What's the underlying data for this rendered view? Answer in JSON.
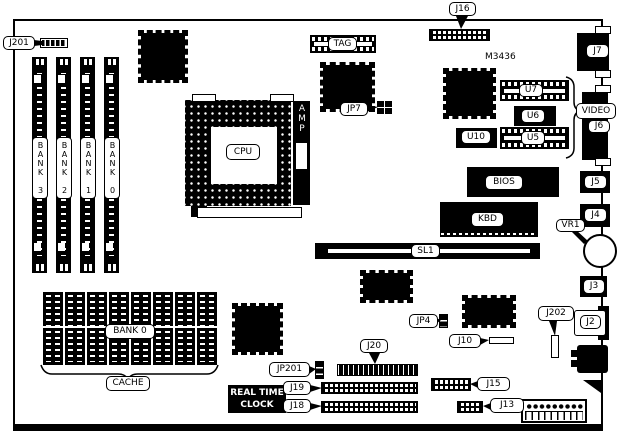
{
  "diagram": {
    "model": "M3436",
    "rtc": {
      "line1": "REAL TIME",
      "line2": "CLOCK"
    }
  },
  "labels": {
    "j201": "J201",
    "j16": "J16",
    "tag": "TAG",
    "jp7": "JP7",
    "cpu": "CPU",
    "amp": "AMP",
    "u7": "U7",
    "u6": "U6",
    "u10": "U10",
    "u5": "U5",
    "video": "VIDEO",
    "j7": "J7",
    "j6": "J6",
    "j5": "J5",
    "j4": "J4",
    "vr1": "VR1",
    "j3": "J3",
    "j2": "J2",
    "j202": "J202",
    "bios": "BIOS",
    "kbd": "KBD",
    "sl1": "SL1",
    "jp4": "JP4",
    "j10": "J10",
    "j20": "J20",
    "jp201": "JP201",
    "j19": "J19",
    "j18": "J18",
    "j15": "J15",
    "j13": "J13",
    "cache": "CACHE",
    "cache_bank": "BANK 0"
  },
  "memory_banks": [
    "BANK 3",
    "BANK 2",
    "BANK 1",
    "BANK 0"
  ],
  "colors": {
    "ink": "#000000",
    "paper": "#ffffff"
  }
}
